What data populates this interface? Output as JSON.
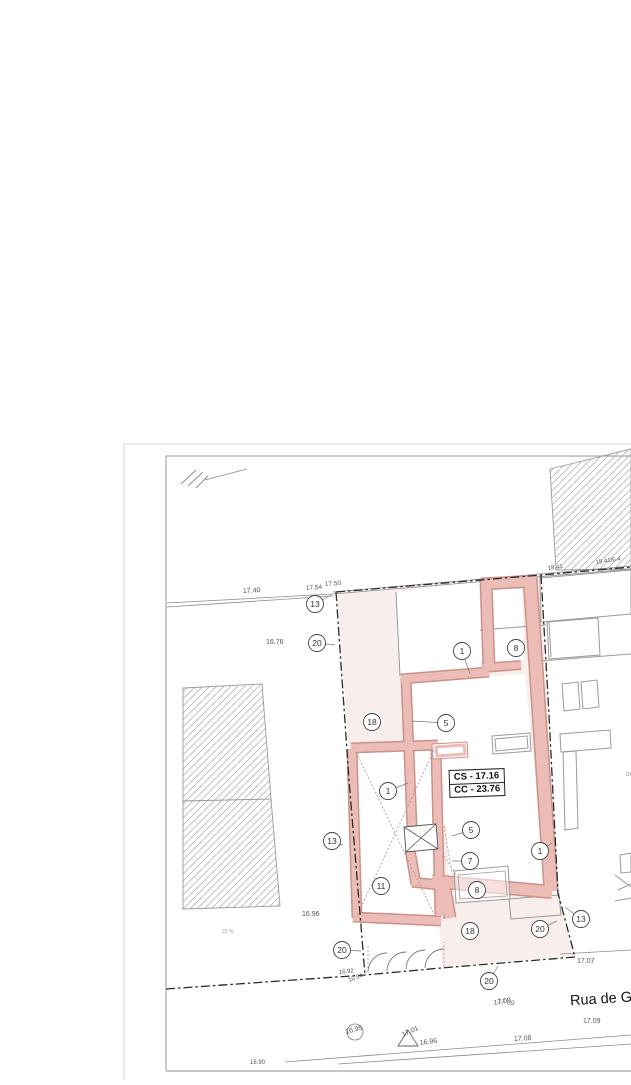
{
  "sheet": {
    "street_label": "Rua de Gui",
    "note_line1": "DO MESMO REQ",
    "note_line2": "PROC : 4/92"
  },
  "info_box": {
    "cs": "CS - 17.16",
    "cc": "CC - 23.76"
  },
  "colors": {
    "wall_fill": "#ecbcb6",
    "wall_edge": "#cc9189",
    "lot_tint": "#f8efec",
    "boundary": "#2a2a2a",
    "outline_gray": "#9a9a9a",
    "hatch": "#b3b3b3"
  },
  "elevation_labels": [
    {
      "text": "17.40",
      "x": 243,
      "y": 593,
      "size": 7,
      "rot": -3
    },
    {
      "text": "17.54",
      "x": 306,
      "y": 590,
      "size": 6.5,
      "rot": -4
    },
    {
      "text": "17.50",
      "x": 325,
      "y": 586,
      "size": 6.5,
      "rot": -4
    },
    {
      "text": "16.76",
      "x": 266,
      "y": 644,
      "size": 7,
      "rot": 0
    },
    {
      "text": "18.41",
      "x": 548,
      "y": 570,
      "size": 6,
      "rot": -8
    },
    {
      "text": "19.41/6.4",
      "x": 596,
      "y": 564,
      "size": 6,
      "rot": -8
    },
    {
      "text": "23 %",
      "x": 222,
      "y": 933,
      "size": 5,
      "rot": 0,
      "color": "#a0a0a0"
    },
    {
      "text": "16.96",
      "x": 302,
      "y": 916,
      "size": 7,
      "rot": 0
    },
    {
      "text": "16.92",
      "x": 339,
      "y": 974,
      "size": 6,
      "rot": -6
    },
    {
      "text": "16.94",
      "x": 349,
      "y": 982,
      "size": 6,
      "rot": -20
    },
    {
      "text": "17.07",
      "x": 577,
      "y": 963,
      "size": 7,
      "rot": 0
    },
    {
      "text": "17.09",
      "x": 494,
      "y": 1005,
      "size": 7,
      "rot": -10
    },
    {
      "text": "17.09",
      "x": 497,
      "y": 1003,
      "size": 7,
      "rot": 8,
      "color": "#777"
    },
    {
      "text": "17.09",
      "x": 583,
      "y": 1023,
      "size": 7,
      "rot": 0
    },
    {
      "text": "17.08",
      "x": 514,
      "y": 1041,
      "size": 7,
      "rot": -3
    },
    {
      "text": "16.96",
      "x": 420,
      "y": 1045,
      "size": 7,
      "rot": -8
    },
    {
      "text": "17.01",
      "x": 403,
      "y": 1037,
      "size": 7,
      "rot": -25
    },
    {
      "text": "16.95",
      "x": 346,
      "y": 1034,
      "size": 7,
      "rot": -15
    },
    {
      "text": "16.90",
      "x": 250,
      "y": 1064,
      "size": 6,
      "rot": 0
    }
  ],
  "markers": [
    {
      "label": "13",
      "x": 315,
      "y": 604,
      "leader": [
        331,
        595
      ]
    },
    {
      "label": "20",
      "x": 317,
      "y": 643,
      "leader": [
        335,
        645
      ]
    },
    {
      "label": "18",
      "x": 372,
      "y": 722,
      "leader": null
    },
    {
      "label": "1",
      "x": 462,
      "y": 651,
      "leader": [
        470,
        674
      ]
    },
    {
      "label": "5",
      "x": 446,
      "y": 723,
      "leader": [
        412,
        721
      ]
    },
    {
      "label": "8",
      "x": 516,
      "y": 648,
      "leader": null
    },
    {
      "label": "1",
      "x": 388,
      "y": 791,
      "leader": [
        408,
        783
      ]
    },
    {
      "label": "13",
      "x": 332,
      "y": 841,
      "leader": [
        343,
        845
      ]
    },
    {
      "label": "5",
      "x": 471,
      "y": 830,
      "leader": [
        452,
        836
      ]
    },
    {
      "label": "7",
      "x": 470,
      "y": 861,
      "leader": [
        452,
        861
      ]
    },
    {
      "label": "11",
      "x": 381,
      "y": 886,
      "leader": null
    },
    {
      "label": "8",
      "x": 477,
      "y": 890,
      "leader": null
    },
    {
      "label": "18",
      "x": 470,
      "y": 931,
      "leader": null
    },
    {
      "label": "20",
      "x": 540,
      "y": 929,
      "leader": [
        557,
        921
      ]
    },
    {
      "label": "13",
      "x": 581,
      "y": 919,
      "leader": [
        565,
        907
      ]
    },
    {
      "label": "20",
      "x": 342,
      "y": 950,
      "leader": [
        361,
        951
      ]
    },
    {
      "label": "20",
      "x": 489,
      "y": 981,
      "leader": [
        498,
        966
      ]
    },
    {
      "label": "1",
      "x": 540,
      "y": 851,
      "leader": [
        552,
        843
      ]
    }
  ]
}
